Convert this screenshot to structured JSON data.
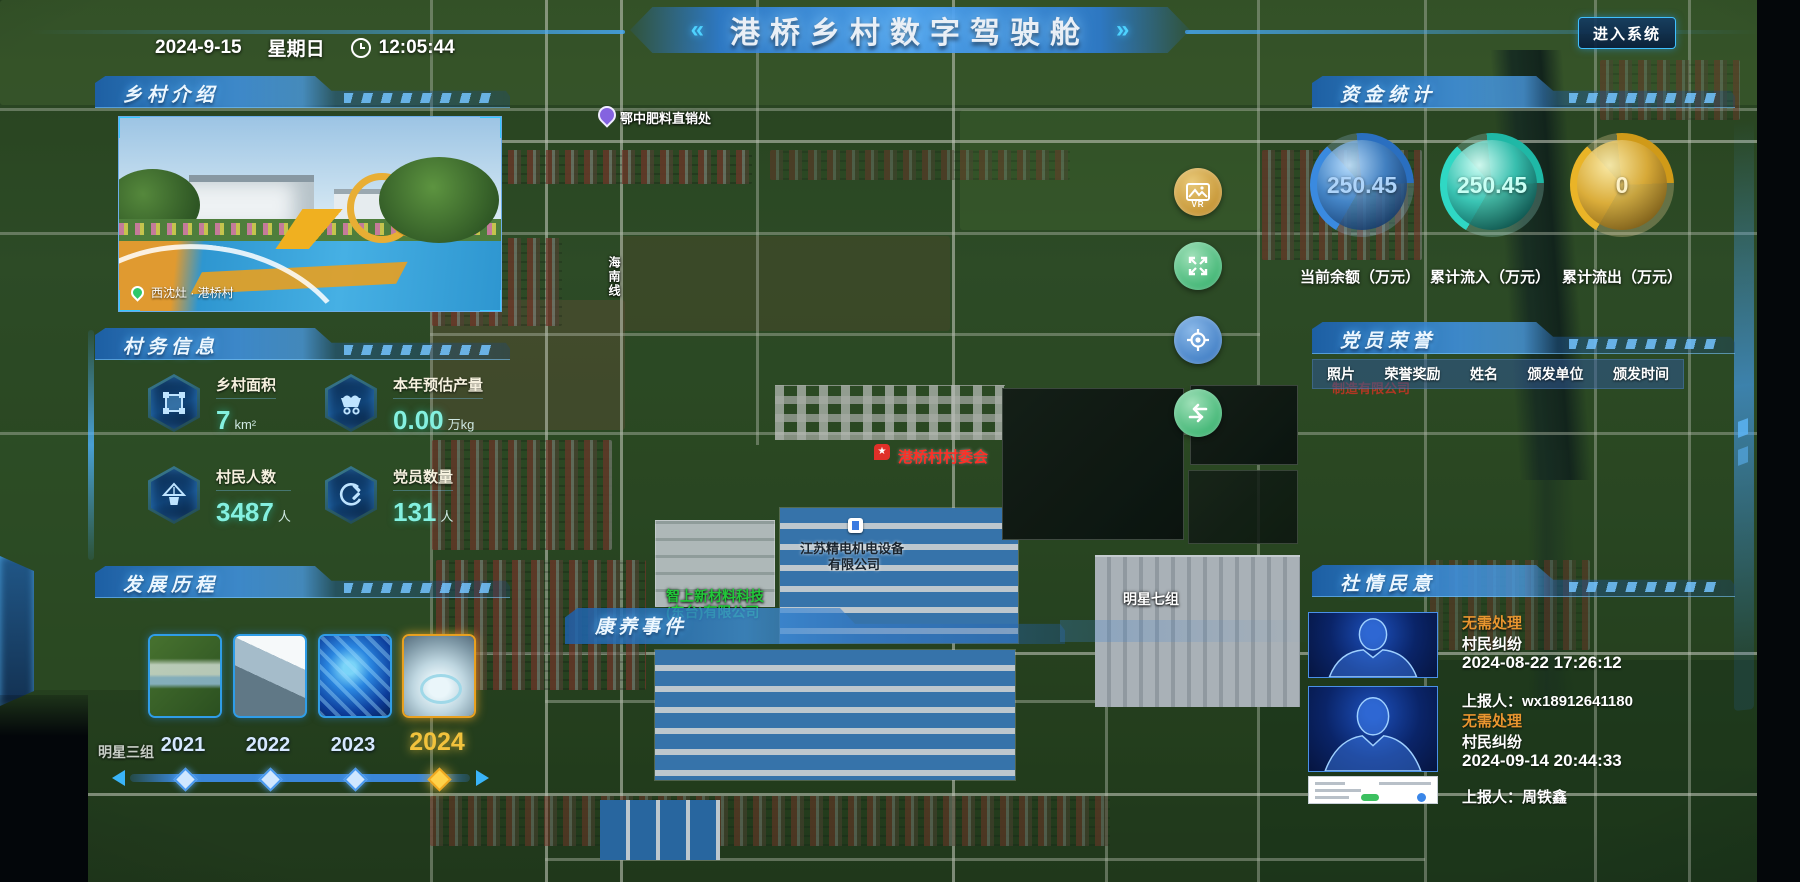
{
  "header": {
    "date": "2024-9-15",
    "weekday": "星期日",
    "time": "12:05:44",
    "left_arrow": "«",
    "title": "港桥乡村数字驾驶舱",
    "right_arrow": "»",
    "enter_button": "进入系统"
  },
  "left": {
    "intro": {
      "title": "乡村介绍",
      "caption": "西沈灶 · 港桥村"
    },
    "info": {
      "title": "村务信息",
      "stats": [
        {
          "label": "乡村面积",
          "value": "7",
          "unit": "km²"
        },
        {
          "label": "本年预估产量",
          "value": "0.00",
          "unit": "万kg"
        },
        {
          "label": "村民人数",
          "value": "3487",
          "unit": "人"
        },
        {
          "label": "党员数量",
          "value": "131",
          "unit": "人"
        }
      ]
    },
    "development": {
      "title": "发展历程",
      "years": [
        "2021",
        "2022",
        "2023",
        "2024"
      ],
      "active_year": "2024"
    }
  },
  "right": {
    "funds": {
      "title": "资金统计",
      "gauges": [
        {
          "value": "250.45",
          "label": "当前余额（万元）",
          "color": "#7fb8f0"
        },
        {
          "value": "250.45",
          "label": "累计流入（万元）",
          "color": "#46ecd4"
        },
        {
          "value": "0",
          "label": "累计流出（万元）",
          "color": "#fdf2c8"
        }
      ]
    },
    "honor": {
      "title": "党员荣誉",
      "columns": [
        "照片",
        "荣誉奖励",
        "姓名",
        "颁发单位",
        "颁发时间"
      ]
    },
    "opinion": {
      "title": "社情民意",
      "items": [
        {
          "status": "无需处理",
          "type": "村民纠纷",
          "time": "2024-08-22 17:26:12",
          "reporter": "上报人：wx18912641180"
        },
        {
          "status": "无需处理",
          "type": "村民纠纷",
          "time": "2024-09-14 20:44:33",
          "reporter": "上报人：周铁鑫"
        }
      ]
    }
  },
  "overlay": {
    "health_events_title": "康养事件"
  },
  "map": {
    "labels": {
      "fertilizer": "鄂中肥料直销处",
      "committee": "港桥村村委会",
      "company1_line1": "江苏精电机电设备",
      "company1_line2": "有限公司",
      "company2_line1": "智上新材料科技",
      "company2_line2": "(东台)有限公司",
      "group7": "明星七组",
      "group3": "明星三组",
      "road": "海南线",
      "factory_red": "制造有限公司"
    },
    "controls": {
      "vr": "VR"
    }
  }
}
